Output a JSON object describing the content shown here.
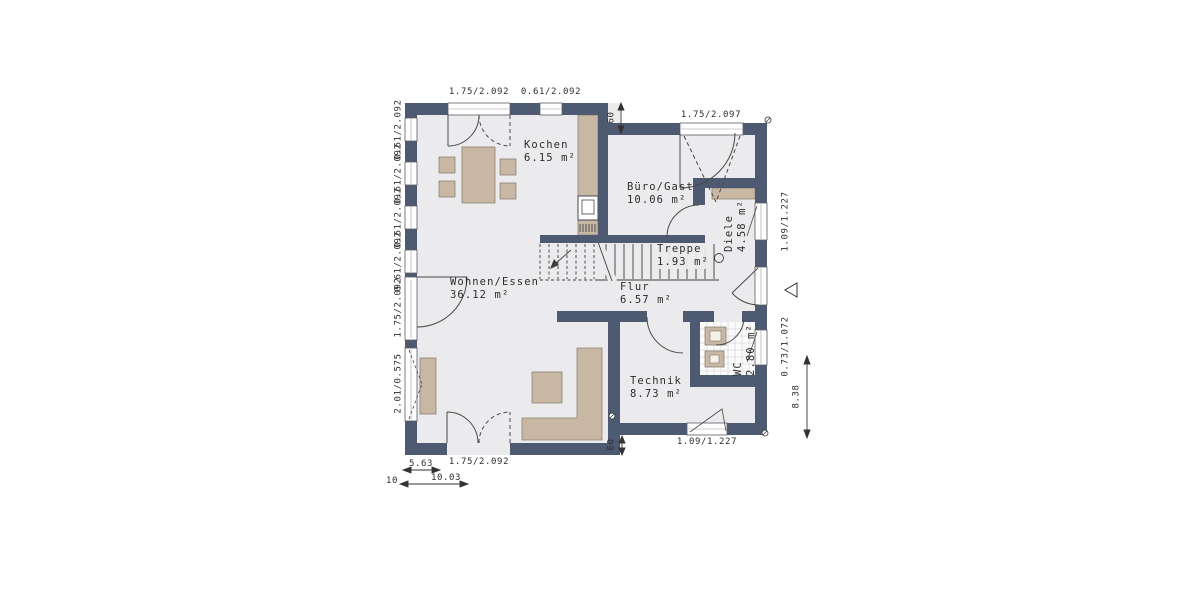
{
  "plan_type": "floor-plan",
  "rooms": {
    "wohnen_essen": {
      "name": "Wohnen/Essen",
      "area": "36.12 m²"
    },
    "kochen": {
      "name": "Kochen",
      "area": "6.15 m²"
    },
    "buero_gast": {
      "name": "Büro/Gast",
      "area": "10.06 m²"
    },
    "diele": {
      "name": "Diele",
      "area": "4.58 m²"
    },
    "treppe": {
      "name": "Treppe",
      "area": "1.93 m²"
    },
    "flur": {
      "name": "Flur",
      "area": "6.57 m²"
    },
    "technik": {
      "name": "Technik",
      "area": "8.73 m²"
    },
    "wc": {
      "name": "WC",
      "area": "2.80 m²"
    }
  },
  "dimensions": {
    "top_terrace_door": "1.75/2.092",
    "top_kitchen_window": "0.61/2.092",
    "buero_window": "1.75/2.097",
    "left_windows": [
      "0.61/2.092",
      "0.61/2.092",
      "0.61/2.092",
      "0.61/2.092"
    ],
    "left_door": "1.75/2.092",
    "left_low_window": "2.01/0.575",
    "diele_window": "1.09/1.227",
    "wc_window": "0.73/1.072",
    "technik_window": "1.09/1.227",
    "bottom_door": "1.75/2.092",
    "wall_offset_top": "60",
    "wall_offset_bottom": "60",
    "height_partial": "8.38",
    "width_partial": "5.63",
    "width_left": "10",
    "width_total": "10.03"
  },
  "colors": {
    "wall": "#4d5a71",
    "floor": "#ebebed",
    "furniture": "#c8b7a3",
    "line": "#3f3f3f",
    "tile_line": "#d8d8da"
  }
}
